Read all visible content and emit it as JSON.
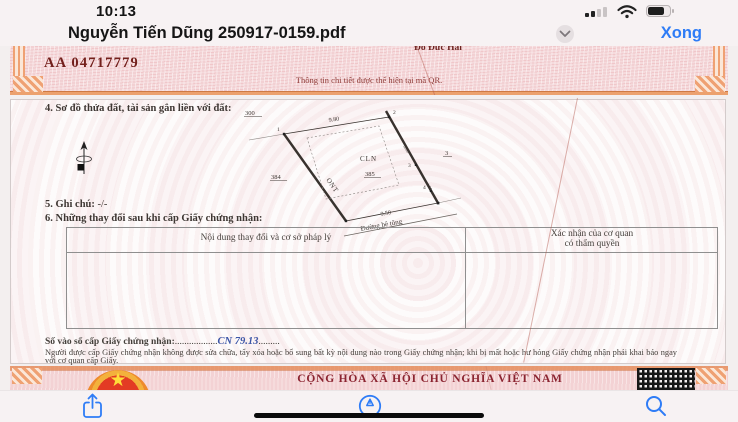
{
  "ui": {
    "status": {
      "time": "10:13"
    },
    "title_bar": {
      "title": "Nguyễn Tiến Dũng 250917-0159.pdf",
      "done": "Xong"
    }
  },
  "doc": {
    "page1": {
      "signer": "Đỗ Đức Hải",
      "serial": "AA 04717779",
      "qr_note": "Thông tin chi tiết được thể hiện tại mã QR.",
      "s4": "4. Sơ đồ thửa đất, tài sản gắn liền với đất:",
      "s5_label": "5. Ghi chú:",
      "s5_value": "-/-",
      "s6": "6. Những thay đổi sau khi cấp Giấy chứng nhận:",
      "table": {
        "col1": "Nội dung thay đổi và cơ sở pháp lý",
        "col2_line1": "Xác nhận của cơ quan",
        "col2_line2": "có thẩm quyền"
      },
      "entry": {
        "label": "Số vào sổ cấp Giấy chứng nhận:",
        "dots1": "..................",
        "value": "CN 79.13",
        "dots2": "........."
      },
      "note": "Người được cấp Giấy chứng nhận không được sửa chữa, tẩy xóa hoặc bổ sung bất kỳ nội dung nào trong Giấy chứng nhận; khi bị mất hoặc hư hỏng Giấy chứng nhận phải khai báo ngay với cơ quan cấp Giấy.",
      "diagram": {
        "neighbor_top": "300",
        "neighbor_left": "384",
        "neighbor_right": "3",
        "parcel": "385",
        "use_left": "ONT",
        "use_right": "CLN",
        "len_top": "9.80",
        "len_bottom": "9.50",
        "len_right_a": "5.65",
        "len_right_b": "4.01",
        "v1": "1",
        "v2": "2",
        "v3": "3",
        "v4": "4",
        "road": "Đường bê tông"
      }
    },
    "page2": {
      "nation": "CỘNG HÒA XÃ HỘI CHỦ NGHĨA VIỆT NAM",
      "star": "★"
    }
  },
  "colors": {
    "accent": "#2e7cf6",
    "doc_red": "#8b2430",
    "serial_red": "#73201c",
    "handwriting_blue": "#3b55a6"
  }
}
